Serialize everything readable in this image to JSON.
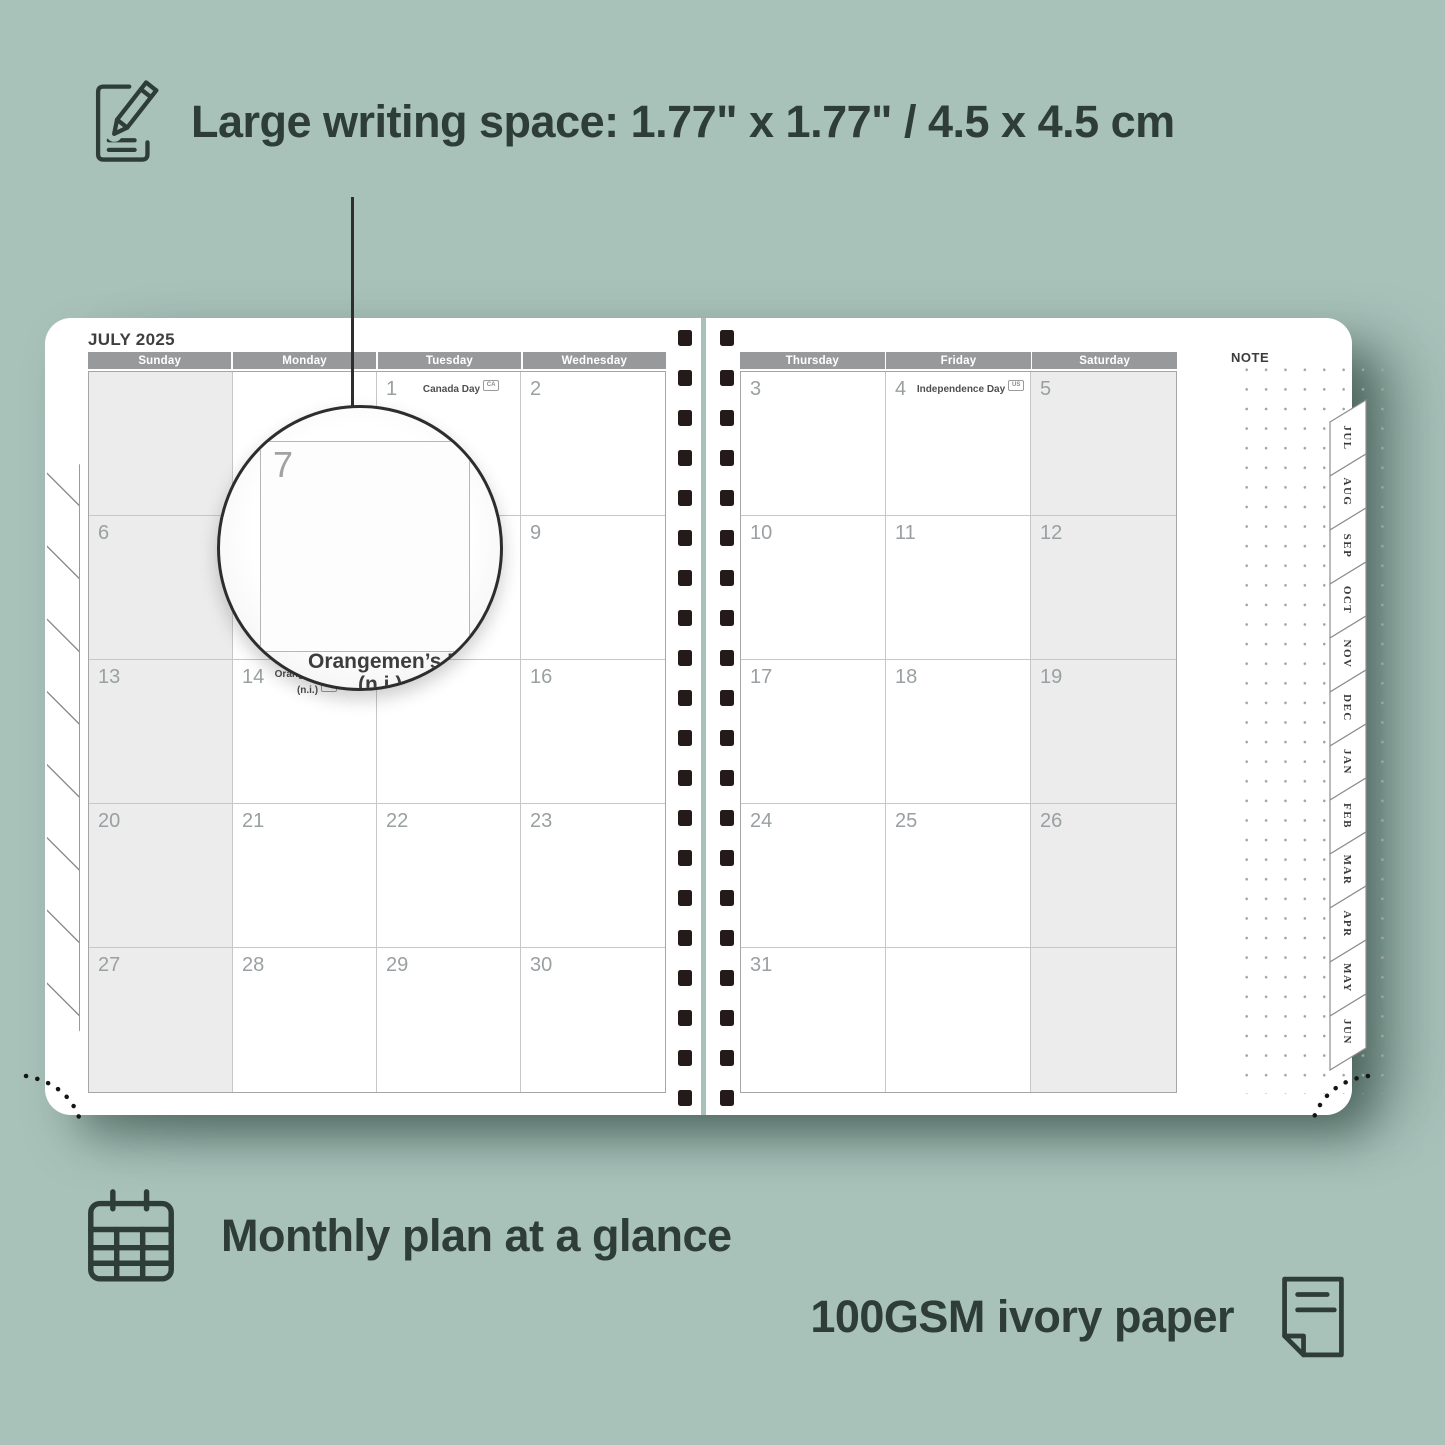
{
  "features": {
    "writing_space": {
      "label": "Large writing space: 1.77\" x 1.77\" / 4.5 x 4.5 cm",
      "icon": "pencil-note-icon"
    },
    "monthly_plan": {
      "label": "Monthly plan at a glance",
      "icon": "calendar-grid-icon"
    },
    "paper": {
      "label": "100GSM ivory paper",
      "icon": "paper-sheet-icon"
    }
  },
  "planner": {
    "month_title": "JULY 2025",
    "note_label": "NOTE",
    "left_headers": [
      "Sunday",
      "Monday",
      "Tuesday",
      "Wednesday"
    ],
    "right_headers": [
      "Thursday",
      "Friday",
      "Saturday"
    ],
    "left_rows": [
      [
        {
          "d": ""
        },
        {
          "d": ""
        },
        {
          "d": "1",
          "holiday": "Canada Day",
          "badge": "CA"
        },
        {
          "d": "2"
        }
      ],
      [
        {
          "d": "6"
        },
        {
          "d": "7"
        },
        {
          "d": "8"
        },
        {
          "d": "9"
        }
      ],
      [
        {
          "d": "13"
        },
        {
          "d": "14",
          "holiday": "Orangemen’s Day (n.i.)",
          "badge": "UK"
        },
        {
          "d": "15"
        },
        {
          "d": "16"
        }
      ],
      [
        {
          "d": "20"
        },
        {
          "d": "21"
        },
        {
          "d": "22"
        },
        {
          "d": "23"
        }
      ],
      [
        {
          "d": "27"
        },
        {
          "d": "28"
        },
        {
          "d": "29"
        },
        {
          "d": "30"
        }
      ]
    ],
    "right_rows": [
      [
        {
          "d": "3"
        },
        {
          "d": "4",
          "holiday": "Independence Day",
          "badge": "US"
        },
        {
          "d": "5"
        }
      ],
      [
        {
          "d": "10"
        },
        {
          "d": "11"
        },
        {
          "d": "12"
        }
      ],
      [
        {
          "d": "17"
        },
        {
          "d": "18"
        },
        {
          "d": "19"
        }
      ],
      [
        {
          "d": "24"
        },
        {
          "d": "25"
        },
        {
          "d": "26"
        }
      ],
      [
        {
          "d": "31"
        },
        {
          "d": ""
        },
        {
          "d": ""
        }
      ]
    ],
    "weekend_columns": {
      "left": [
        0
      ],
      "right": [
        2
      ]
    },
    "tabs": [
      "JUL",
      "AUG",
      "SEP",
      "OCT",
      "NOV",
      "DEC",
      "JAN",
      "FEB",
      "MAR",
      "APR",
      "MAY",
      "JUN"
    ],
    "magnifier": {
      "day": "7",
      "caption_line1": "Orangemen’s Day",
      "caption_line2": "(n.i.)"
    }
  },
  "colors": {
    "background": "#a8c2ba",
    "headline_text": "#2e3d38",
    "day_header_bar": "#97999a",
    "weekend_cell": "#ebeceb",
    "spiral_hole": "#241a19",
    "page": "#ffffff"
  }
}
